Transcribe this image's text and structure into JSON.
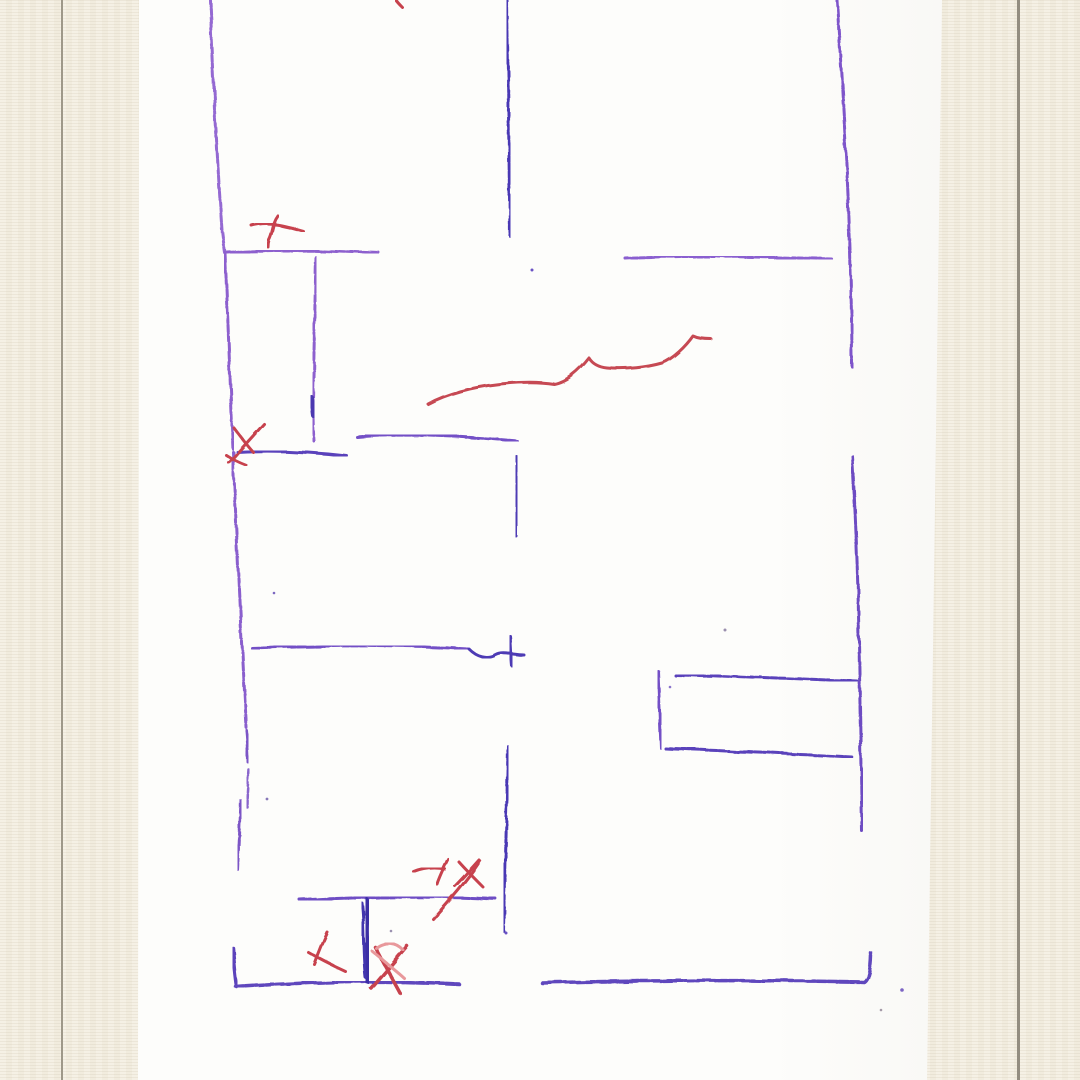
{
  "scene": {
    "surface_color": "#f4efe2",
    "paper_color": "#fdfdfb",
    "margin_rule_color": "#9e9889",
    "wall_purple_light": "#8d61ce",
    "wall_purple_dark": "#4a38b4",
    "mark_red": "#c7424e",
    "mark_salmon": "#e8989b"
  },
  "sketch": {
    "strokes": [
      {
        "name": "left-wall-top",
        "d": "M210,0 C213,70 217,160 222,230 C223,238 224,246 225,253",
        "color": "#9469d2",
        "w": 3,
        "dash": "6 2"
      },
      {
        "name": "left-wall-upper-mid",
        "d": "M225,253 C228,320 230,380 233,450",
        "color": "#8d61ce",
        "w": 3,
        "dash": "7 2"
      },
      {
        "name": "left-wall-lower-mid",
        "d": "M233,452 C237,545 241,640 246,727",
        "color": "#8a5ecd",
        "w": 3,
        "dash": "8 2.5"
      },
      {
        "name": "left-wall-dash-1",
        "d": "M246,730 C247,742 248,752 248,762",
        "color": "#7b54c6",
        "w": 3
      },
      {
        "name": "left-wall-dash-2",
        "d": "M249,770 C248,783 247,795 247,807",
        "color": "#8a66cc",
        "w": 2.5,
        "dash": "4 2"
      },
      {
        "name": "left-wall-dash-3",
        "d": "M241,800 C240,824 239,848 238,871",
        "color": "#7b54c6",
        "w": 3,
        "dash": "6 2"
      },
      {
        "name": "left-wall-bottom-corner",
        "d": "M233,948 C234,961 235,974 237,987",
        "color": "#5b43bb",
        "w": 3.5
      },
      {
        "name": "bottom-wall-left",
        "d": "M236,987 C300,982 380,980 459,984",
        "color": "#5e46bd",
        "w": 3.5,
        "dash": "8 2"
      },
      {
        "name": "bottom-wall-right",
        "d": "M542,983 C640,980 770,980 864,982 C869,979 871,966 871,953",
        "color": "#5e46bd",
        "w": 3.5,
        "dash": "9 2"
      },
      {
        "name": "top-room-divider",
        "d": "M227,252 C275,249 330,251 379,253",
        "color": "#8d61ce",
        "w": 3,
        "dash": "6 2"
      },
      {
        "name": "top-divider-vertical",
        "d": "M316,257 C315,300 314,355 313,400 C313,414 313,427 314,441",
        "color": "#8d61ce",
        "w": 3,
        "dash": "7 2.5"
      },
      {
        "name": "top-divider-vertical-blob",
        "d": "M311,397 C313,403 313,409 314,416",
        "color": "#4b38b0",
        "w": 5
      },
      {
        "name": "top-center-wall",
        "d": "M507,0 C508,70 509,155 510,236",
        "color": "#4a38b4",
        "w": 3,
        "dash": "6 1.8"
      },
      {
        "name": "top-right-divider",
        "d": "M625,258 C685,255 765,257 833,259",
        "color": "#8a5ed0",
        "w": 3,
        "dash": "5 2.2"
      },
      {
        "name": "right-wall-top",
        "d": "M837,0 C842,85 848,175 850,250 C851,290 852,330 852,368",
        "color": "#7e54ca",
        "w": 3,
        "dash": "7 2"
      },
      {
        "name": "right-wall-mid",
        "d": "M852,456 C856,520 858,580 859,640 C860,705 861,770 862,831",
        "color": "#6d4cc2",
        "w": 3,
        "dash": "8 2"
      },
      {
        "name": "middle-divider-left",
        "d": "M237,452 C272,450 312,452 347,456",
        "color": "#5a43bb",
        "w": 3
      },
      {
        "name": "middle-divider-right",
        "d": "M357,437 C400,433 462,436 517,441",
        "color": "#7350c6",
        "w": 3,
        "dash": "6 2"
      },
      {
        "name": "middle-divider-vertical",
        "d": "M517,457 C517,483 516,510 516,536",
        "color": "#4e3ab4",
        "w": 3
      },
      {
        "name": "lower-divider",
        "d": "M252,648 C320,645 400,645 469,649",
        "color": "#7350c6",
        "w": 3,
        "dash": "7 2"
      },
      {
        "name": "lower-divider-wave",
        "d": "M469,649 C477,657 487,660 496,655 C503,651 513,655 524,655",
        "color": "#4e3ab4",
        "w": 3
      },
      {
        "name": "lower-divider-tick",
        "d": "M510,636 C511,646 511,656 512,666",
        "color": "#4e3ab4",
        "w": 3
      },
      {
        "name": "closet-rect-left",
        "d": "M658,671 C659,697 660,722 661,748",
        "color": "#7350c6",
        "w": 3
      },
      {
        "name": "closet-rect-top",
        "d": "M675,675 C735,676 800,679 857,681",
        "color": "#5a43bb",
        "w": 3,
        "dash": "6 2"
      },
      {
        "name": "closet-rect-bottom",
        "d": "M665,748 C725,751 792,754 853,757",
        "color": "#5a43bb",
        "w": 3,
        "dash": "7 2"
      },
      {
        "name": "bottom-center-wall",
        "d": "M508,746 C507,805 505,870 504,932",
        "color": "#4a38b4",
        "w": 3,
        "dash": "6 1.8"
      },
      {
        "name": "bottom-left-divider",
        "d": "M300,900 C362,897 432,896 497,899",
        "color": "#6e4dc4",
        "w": 3,
        "dash": "7 2"
      },
      {
        "name": "dark-door-scribble-a",
        "d": "M366,900 C369,916 365,932 368,948 C370,960 367,971 368,981",
        "color": "#3b2da5",
        "w": 6
      },
      {
        "name": "dark-door-scribble-b",
        "d": "M362,903 C365,928 363,952 366,978",
        "color": "#4334ae",
        "w": 3
      },
      {
        "name": "red-top-tick",
        "d": "M396,0 C398,3 400,5 403,8",
        "color": "#c7424e",
        "w": 3
      },
      {
        "name": "red-arrow-horizontal",
        "d": "M252,226 C269,221 286,226 303,231",
        "color": "#c7424e",
        "w": 3
      },
      {
        "name": "red-arrow-vertical",
        "d": "M278,216 C272,224 273,233 269,240 C268,243 268,245 268,247",
        "color": "#c7424e",
        "w": 3
      },
      {
        "name": "red-corner-x-a",
        "d": "M264,424 C252,437 240,450 229,463",
        "color": "#c7424e",
        "w": 3
      },
      {
        "name": "red-corner-x-b",
        "d": "M234,428 C240,436 246,444 253,452",
        "color": "#c7424e",
        "w": 3
      },
      {
        "name": "red-corner-x-c",
        "d": "M226,455 C232,459 238,462 246,465",
        "color": "#c7424e",
        "w": 3
      },
      {
        "name": "red-squiggle-line",
        "d": "M428,404 C446,394 472,387 500,384 C518,382 536,381 554,384 C566,382 579,371 589,358 C592,363 598,367 607,368 C626,370 648,367 662,363 C673,359 686,346 693,336 C697,338 704,339 711,339",
        "color": "#c64a52",
        "w": 3
      },
      {
        "name": "red-y-mark-horizontal",
        "d": "M414,872 C424,868 434,867 445,869",
        "color": "#c7424e",
        "w": 3
      },
      {
        "name": "red-y-mark-diagonal",
        "d": "M448,859 C444,867 440,875 437,884",
        "color": "#c7424e",
        "w": 3
      },
      {
        "name": "red-mid-x-a",
        "d": "M459,862 C467,871 476,880 484,888",
        "color": "#c7424e",
        "w": 3
      },
      {
        "name": "red-mid-x-b",
        "d": "M479,860 C471,869 463,878 455,886",
        "color": "#c7424e",
        "w": 3
      },
      {
        "name": "red-long-diagonal",
        "d": "M480,861 C467,881 449,901 433,919",
        "color": "#c7424e",
        "w": 3
      },
      {
        "name": "red-bottom-x1-a",
        "d": "M327,932 C322,943 318,953 314,964",
        "color": "#c7424e",
        "w": 3
      },
      {
        "name": "red-bottom-x1-b",
        "d": "M308,952 C320,959 332,965 345,971",
        "color": "#c7424e",
        "w": 3
      },
      {
        "name": "red-bottom-x2-a",
        "d": "M375,947 C383,963 392,978 400,993",
        "color": "#c7424e",
        "w": 3.5
      },
      {
        "name": "red-bottom-x2-b",
        "d": "M407,946 C395,960 383,974 371,988",
        "color": "#c7424e",
        "w": 3.5
      },
      {
        "name": "red-bottom-x2-c",
        "d": "M372,951 C383,960 394,969 404,978",
        "color": "#e8989b",
        "w": 3
      },
      {
        "name": "red-bottom-x2-d",
        "d": "M376,948 C385,941 396,942 403,950",
        "color": "#e8989b",
        "w": 3
      }
    ],
    "specks": [
      {
        "name": "speck-1",
        "x": 532,
        "y": 270,
        "r": 1.5,
        "color": "#6a52c4"
      },
      {
        "name": "speck-2",
        "x": 274,
        "y": 593,
        "r": 1.3,
        "color": "#7c68c0"
      },
      {
        "name": "speck-3",
        "x": 725,
        "y": 630,
        "r": 1.5,
        "color": "#9a8fae"
      },
      {
        "name": "speck-4",
        "x": 267,
        "y": 799,
        "r": 1.4,
        "color": "#8878b8"
      },
      {
        "name": "speck-5",
        "x": 391,
        "y": 931,
        "r": 1.3,
        "color": "#9a90b0"
      },
      {
        "name": "speck-6",
        "x": 506,
        "y": 933,
        "r": 1.5,
        "color": "#6a52c4"
      },
      {
        "name": "speck-7",
        "x": 670,
        "y": 687,
        "r": 1.3,
        "color": "#8a74cc"
      },
      {
        "name": "speck-8",
        "x": 902,
        "y": 990,
        "r": 1.8,
        "color": "#7c64c4"
      },
      {
        "name": "speck-9",
        "x": 881,
        "y": 1010,
        "r": 1.3,
        "color": "#a49aa8"
      }
    ]
  }
}
